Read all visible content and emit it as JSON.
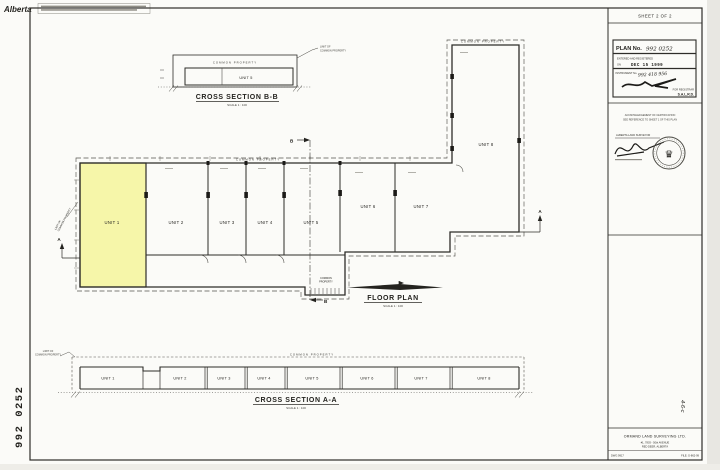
{
  "header": {
    "brand": "Alberta"
  },
  "sheet": {
    "label": "SHEET 2 OF 2"
  },
  "registration": {
    "plan_no_label": "PLAN No.",
    "plan_no_value": "992 0252",
    "entered": "ENTERED AND REGISTERED",
    "on": "ON",
    "date": "DEC 15 1999",
    "instrument_label": "INSTRUMENT No.",
    "instrument_value": "992 418 956",
    "registrar": "FOR REGISTRAR",
    "district": "S.A.L.R.D."
  },
  "acknowledgment": {
    "line1": "ACKNOWLEDGEMENT OF CERTIFICATION",
    "line2": "SEE REFERENCE TO SHEET 1 OF THIS PLAN",
    "surveyor": "ALBERTA LAND SURVEYOR"
  },
  "floor_plan": {
    "title": "FLOOR PLAN",
    "scale": "SCALE 1 : 100",
    "common_property": "COMMON PROPERTY",
    "common": "COMMON",
    "property": "PROPERTY",
    "limit1": "LIMIT OF",
    "limit2": "COMMON PROPERTY",
    "marker_a": "A",
    "marker_b": "B"
  },
  "sections": {
    "bb": {
      "title": "CROSS SECTION B-B",
      "scale": "SCALE 1 : 100",
      "unit": "UNIT 5",
      "common_property": "COMMON PROPERTY",
      "limit1": "LIMIT OF",
      "limit2": "COMMON PROPERTY"
    },
    "aa": {
      "title": "CROSS SECTION A-A",
      "scale": "SCALE 1 : 100",
      "common_property": "COMMON PROPERTY",
      "limit1": "LIMIT OF",
      "limit2": "COMMON PROPERTY"
    }
  },
  "units": [
    "UNIT 1",
    "UNIT 2",
    "UNIT 3",
    "UNIT 4",
    "UNIT 5",
    "UNIT 6",
    "UNIT 7",
    "UNIT 8"
  ],
  "stamps": {
    "plan_number_vertical": "992 0252",
    "margin_note": "4-6-c"
  },
  "firm": {
    "name": "ORMAND LAND SURVEYING LTD.",
    "address1": "#1, 7803 - 50th AVENUE",
    "address2": "RED DEER, ALBERTA",
    "dwg": "DWG 9917",
    "file": "FILE: G-862-99"
  },
  "colors": {
    "unit1_highlight": "#f6f6a9",
    "paper": "#fbfbf8",
    "line": "#2e2d29"
  }
}
